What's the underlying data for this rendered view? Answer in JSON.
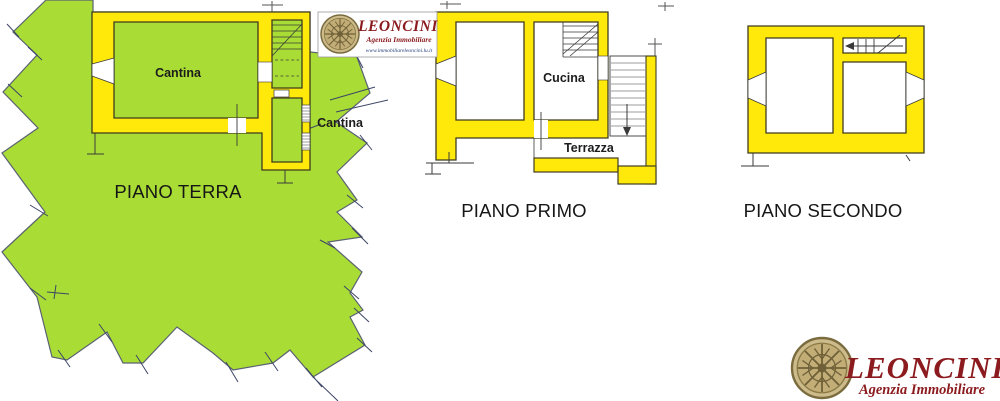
{
  "document_type": "planimetria",
  "floors": {
    "terra": {
      "label": "PIANO TERRA",
      "room1": "Cantina",
      "room2": "Cantina"
    },
    "primo": {
      "label": "PIANO PRIMO",
      "kitchen": "Cucina",
      "terrace": "Terrazza"
    },
    "secondo": {
      "label": "PIANO SECONDO"
    }
  },
  "branding": {
    "top_logo": {
      "name": "LEONCINI",
      "tagline": "Agenzia Immobiliare",
      "website": "www.immobiliareleoncini.lu.it"
    },
    "bottom_logo": {
      "name": "LEONCINI",
      "tagline": "Agenzia Immobiliare"
    }
  },
  "colors": {
    "wall_yellow": "#ffe90a",
    "parcel_green": "#a9dd35",
    "outline_dark": "#3f3c1f",
    "boundary_navy": "#3c4566",
    "logo_red": "#8b1b1e",
    "emblem_tan": "#c9b784"
  }
}
